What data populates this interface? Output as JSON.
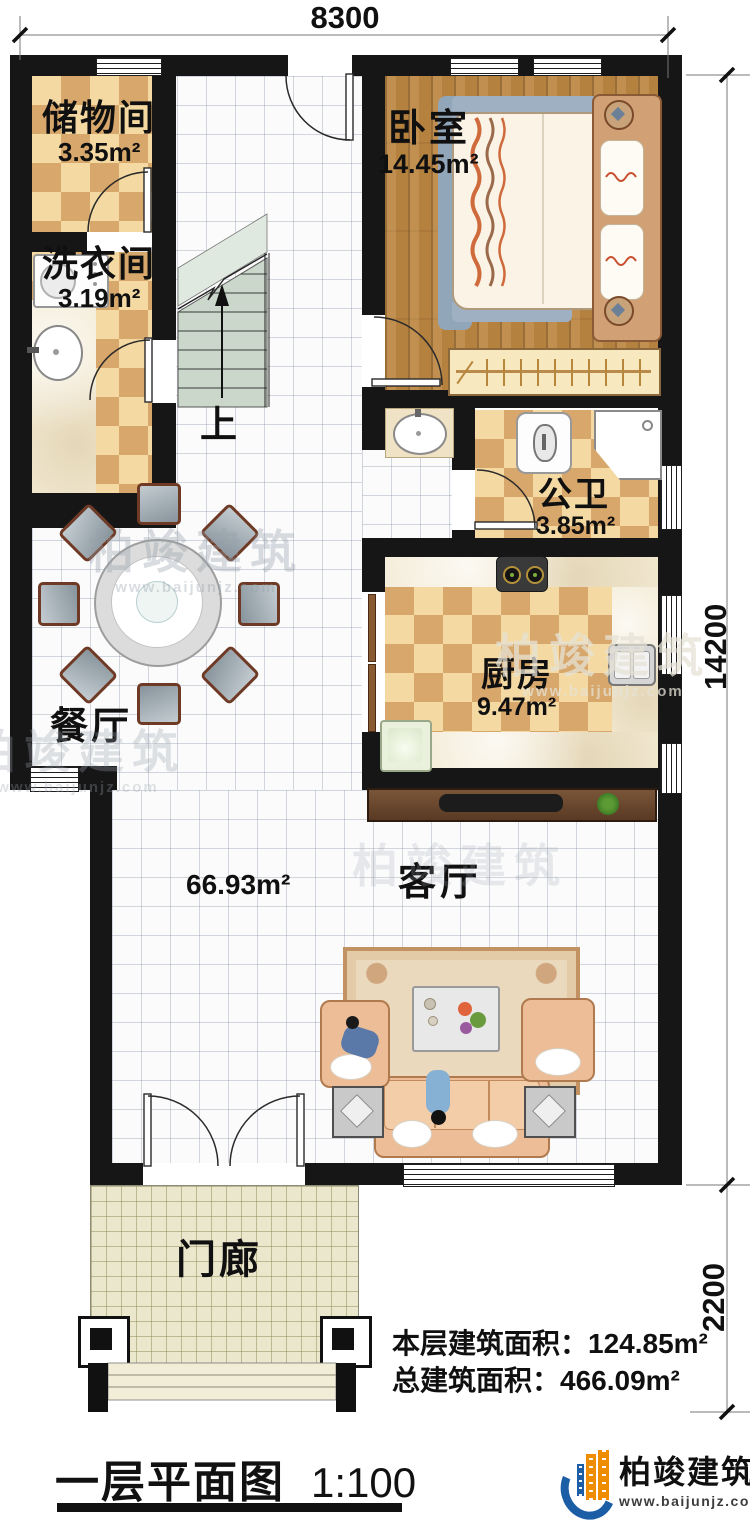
{
  "plan": {
    "dimensions": {
      "width_top": "8300",
      "height_main": "14200",
      "height_porch": "2200"
    },
    "rooms": {
      "storage": {
        "name": "储物间",
        "area": "3.35m²"
      },
      "laundry": {
        "name": "洗衣间",
        "area": "3.19m²"
      },
      "bedroom": {
        "name": "卧室",
        "area": "14.45m²"
      },
      "bathroom": {
        "name": "公卫",
        "area": "3.85m²"
      },
      "kitchen": {
        "name": "厨房",
        "area": "9.47m²"
      },
      "dining": {
        "name": "餐厅"
      },
      "living": {
        "name": "客厅"
      },
      "porch": {
        "name": "门廊"
      },
      "hall": {
        "area": "66.93m²"
      },
      "stairs": {
        "direction_label": "上"
      }
    },
    "notes": {
      "floor_area": "本层建筑面积：124.85m²",
      "total_area": "总建筑面积：466.09m²"
    },
    "title": {
      "text": "一层平面图",
      "scale": "1:100"
    },
    "brand": {
      "name": "柏竣建筑",
      "website": "www.baijunjz.com"
    },
    "watermark": {
      "text": "柏竣建筑",
      "website": "www.baijunjz.com"
    },
    "colors": {
      "wall": "#161616",
      "checker_dark": "#d8a76b",
      "checker_light": "#f4daa2",
      "wood_floor": "#b5813f",
      "stair_tread": "#cbd7ca",
      "brand_blue": "#1b5ea6",
      "brand_orange": "#f08c00"
    }
  }
}
